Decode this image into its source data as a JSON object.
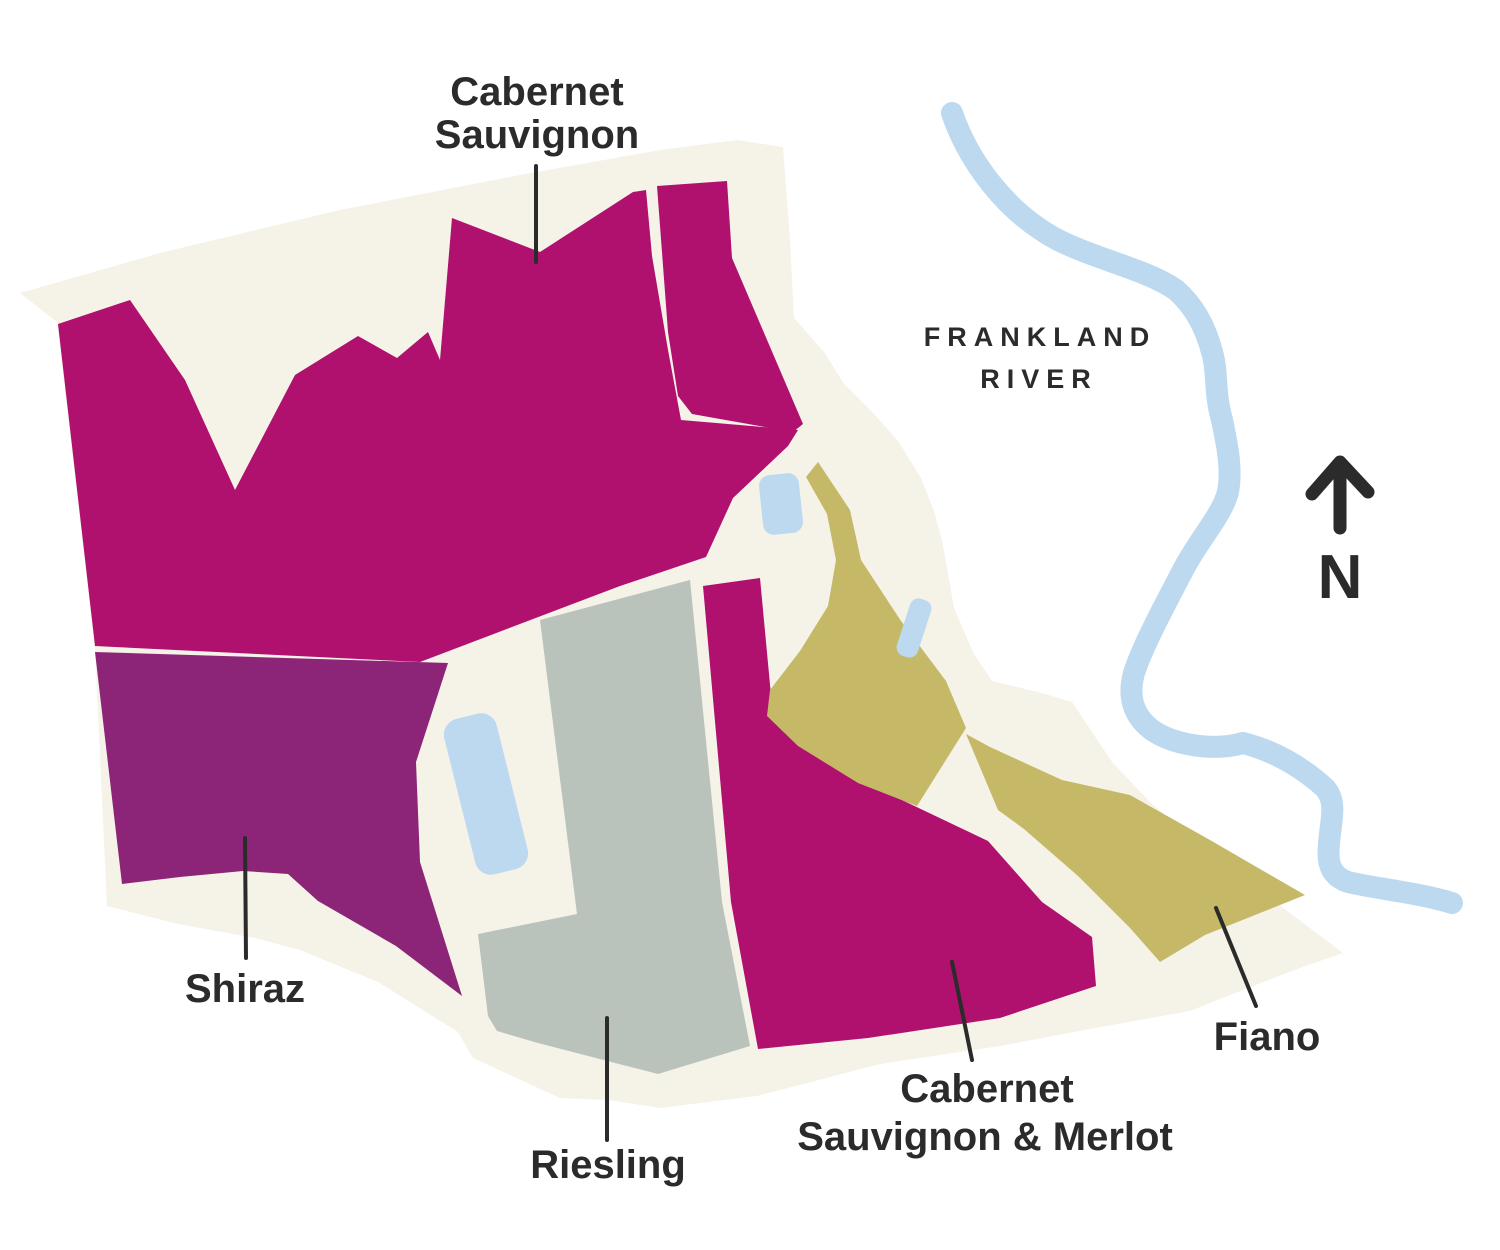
{
  "map": {
    "name": "Frankland River vineyard block map",
    "colors": {
      "background": "#ffffff",
      "land": "#f5f2e8",
      "magenta": "#b0106e",
      "purple": "#8c2577",
      "sage": "#b9c3bb",
      "olive": "#c5b968",
      "water": "#bcd9f0",
      "ink": "#2b2b2b"
    },
    "labels": {
      "cabernet_sauvignon": {
        "line1": "Cabernet",
        "line2": "Sauvignon"
      },
      "shiraz": "Shiraz",
      "riesling": "Riesling",
      "cabernet_sauvignon_merlot": {
        "line1": "Cabernet",
        "line2": "Sauvignon & Merlot"
      },
      "fiano": "Fiano"
    },
    "river": {
      "line1": "FRANKLAND",
      "line2": "RIVER"
    },
    "compass": {
      "label": "N"
    },
    "regions": [
      {
        "variety": "Cabernet Sauvignon",
        "color": "#b0106e"
      },
      {
        "variety": "Shiraz",
        "color": "#8c2577"
      },
      {
        "variety": "Riesling",
        "color": "#b9c3bb"
      },
      {
        "variety": "Cabernet Sauvignon & Merlot",
        "color": "#b0106e"
      },
      {
        "variety": "Fiano",
        "color": "#c5b968"
      }
    ],
    "water_features": {
      "river_name": "Frankland River",
      "dam_count": 3
    }
  }
}
